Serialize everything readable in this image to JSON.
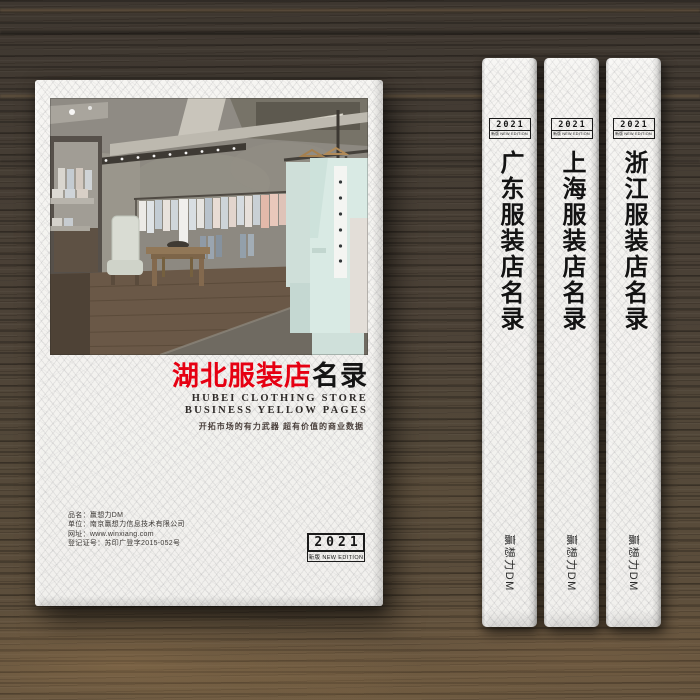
{
  "cover": {
    "title_red": "湖北服装店",
    "title_black": "名录",
    "subtitle_line1": "HUBEI CLOTHING STORE",
    "subtitle_line2": "BUSINESS YELLOW PAGES",
    "tagline": "开拓市场的有力武器  超有价值的商业数据",
    "info_lines": [
      "品名：赢想力DM",
      "单位：南京赢想力信息技术有限公司",
      "网址：www.winxiang.com",
      "登记证号：苏印广登字2015-052号"
    ],
    "badge": {
      "year": "2021",
      "edition": "新版 NEW EDITION"
    },
    "photo_subject": "clothing-store-interior"
  },
  "spines": [
    {
      "title": "广东服装店名录",
      "badge": {
        "year": "2021",
        "edition": "新版 NEW EDITION"
      },
      "brand": "赢想力DM"
    },
    {
      "title": "上海服装店名录",
      "badge": {
        "year": "2021",
        "edition": "新版 NEW EDITION"
      },
      "brand": "赢想力DM"
    },
    {
      "title": "浙江服装店名录",
      "badge": {
        "year": "2021",
        "edition": "新版 NEW EDITION"
      },
      "brand": "赢想力DM"
    }
  ],
  "colors": {
    "accent_red": "#e60012",
    "ink": "#1a1a1a",
    "paper": "#f5f4f1",
    "wood_dark": "#453c33",
    "wood_light": "#8a6f4f",
    "suit_mint": "#d9eae4"
  }
}
